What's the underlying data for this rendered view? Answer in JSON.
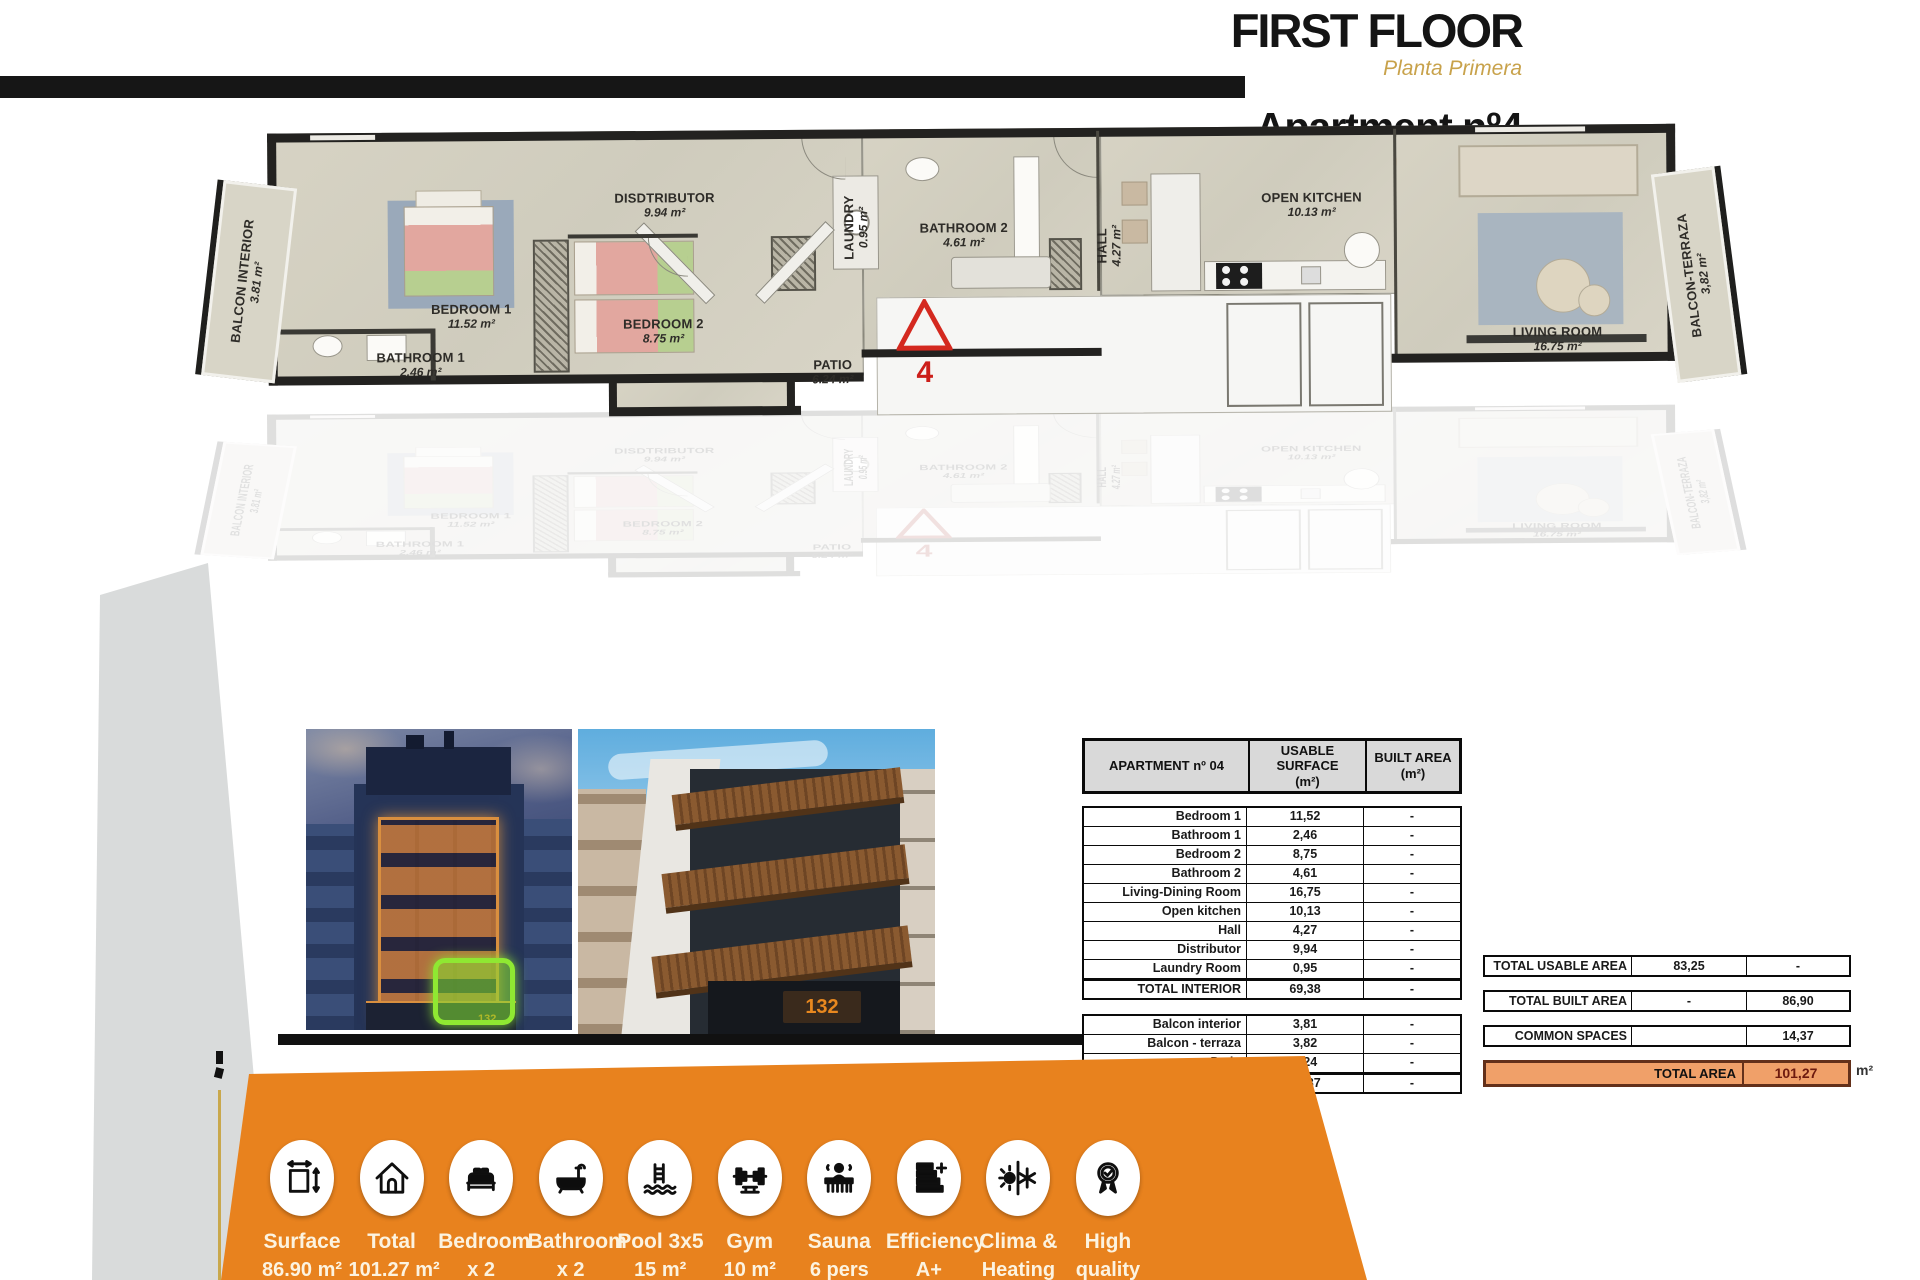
{
  "header": {
    "floor_title": "FIRST FLOOR",
    "floor_subtitle": "Planta Primera",
    "apartment_title": "Apartment nº4",
    "apartment_subtitle": "Apartamento nº 4"
  },
  "floorplan": {
    "marker": "4",
    "rooms": [
      {
        "name": "BALCON INTERIOR",
        "area": "3.81 m²"
      },
      {
        "name": "BEDROOM 1",
        "area": "11.52 m²"
      },
      {
        "name": "BATHROOM 1",
        "area": "2.46 m²"
      },
      {
        "name": "DISDTRIBUTOR",
        "area": "9.94 m²"
      },
      {
        "name": "BEDROOM 2",
        "area": "8.75 m²"
      },
      {
        "name": "LAUNDRY",
        "area": "0.95 m²"
      },
      {
        "name": "PATIO",
        "area": "6.24 m²"
      },
      {
        "name": "BATHROOM 2",
        "area": "4.61 m²"
      },
      {
        "name": "HALL",
        "area": "4.27 m²"
      },
      {
        "name": "OPEN KITCHEN",
        "area": "10.13 m²"
      },
      {
        "name": "LIVING ROOM",
        "area": "16.75 m²"
      },
      {
        "name": "BALCON-TERRAZA",
        "area": "3,82 m²"
      }
    ]
  },
  "photos": {
    "night_sign": "132",
    "day_sign": "132"
  },
  "surface_table": {
    "title": "APARTMENT nº 04",
    "col_usable": "USABLE SURFACE",
    "col_usable_unit": "(m²)",
    "col_built": "BUILT AREA",
    "col_built_unit": "(m²)",
    "interior_rows": [
      {
        "label": "Bedroom 1",
        "usable": "11,52",
        "built": "-"
      },
      {
        "label": "Bathroom 1",
        "usable": "2,46",
        "built": "-"
      },
      {
        "label": "Bedroom 2",
        "usable": "8,75",
        "built": "-"
      },
      {
        "label": "Bathroom 2",
        "usable": "4,61",
        "built": "-"
      },
      {
        "label": "Living-Dining Room",
        "usable": "16,75",
        "built": "-"
      },
      {
        "label": "Open kitchen",
        "usable": "10,13",
        "built": "-"
      },
      {
        "label": "Hall",
        "usable": "4,27",
        "built": "-"
      },
      {
        "label": "Distributor",
        "usable": "9,94",
        "built": "-"
      },
      {
        "label": "Laundry Room",
        "usable": "0,95",
        "built": "-"
      },
      {
        "label": "TOTAL INTERIOR",
        "usable": "69,38",
        "built": "-",
        "cls": "total"
      }
    ],
    "exterior_rows": [
      {
        "label": "Balcon interior",
        "usable": "3,81",
        "built": "-"
      },
      {
        "label": "Balcon - terraza",
        "usable": "3,82",
        "built": "-"
      },
      {
        "label": "Patio",
        "usable": "6,24",
        "built": "-"
      },
      {
        "label": "TOTAL EXTERIOR",
        "usable": "13,87",
        "built": "-",
        "cls": "total"
      }
    ]
  },
  "totals": {
    "rows": [
      {
        "label": "TOTAL USABLE AREA",
        "usable": "83,25",
        "built": "-"
      },
      {
        "label": "TOTAL BUILT AREA",
        "usable": "-",
        "built": "86,90"
      },
      {
        "label": "COMMON SPACES",
        "usable": "",
        "built": "14,37"
      }
    ],
    "grand_label": "TOTAL AREA",
    "grand_value": "101,27",
    "grand_unit": "m²"
  },
  "amenities": [
    {
      "icon_ref": "#i-dim",
      "icon_name": "dimensions-icon",
      "line1": "Surface",
      "line2": "86.90 m²"
    },
    {
      "icon_ref": "#i-house",
      "icon_name": "house-icon",
      "line1": "Total",
      "line2": "101.27 m²"
    },
    {
      "icon_ref": "#i-bed",
      "icon_name": "bed-icon",
      "line1": "Bedroom",
      "line2": "x 2"
    },
    {
      "icon_ref": "#i-bath",
      "icon_name": "bathtub-icon",
      "line1": "Bathroom",
      "line2": "x 2"
    },
    {
      "icon_ref": "#i-pool",
      "icon_name": "pool-ladder-icon",
      "line1": "Pool 3x5",
      "line2": "15 m²"
    },
    {
      "icon_ref": "#i-gym",
      "icon_name": "gym-icon",
      "line1": "Gym",
      "line2": "10 m²"
    },
    {
      "icon_ref": "#i-sauna",
      "icon_name": "sauna-icon",
      "line1": "Sauna",
      "line2": "6 pers"
    },
    {
      "icon_ref": "#i-eff",
      "icon_name": "energy-efficiency-icon",
      "line1": "Efficiency",
      "line2": "A+"
    },
    {
      "icon_ref": "#i-clima",
      "icon_name": "climate-heating-icon",
      "line1": "Clima &",
      "line2": "Heating"
    },
    {
      "icon_ref": "#i-quality",
      "icon_name": "high-quality-icon",
      "line1": "High",
      "line2": "quality"
    }
  ],
  "colors": {
    "accent_orange": "#e8821e",
    "gold": "#c8a24b",
    "highlight_green": "#86e62e",
    "total_row_orange": "#f0a069"
  }
}
